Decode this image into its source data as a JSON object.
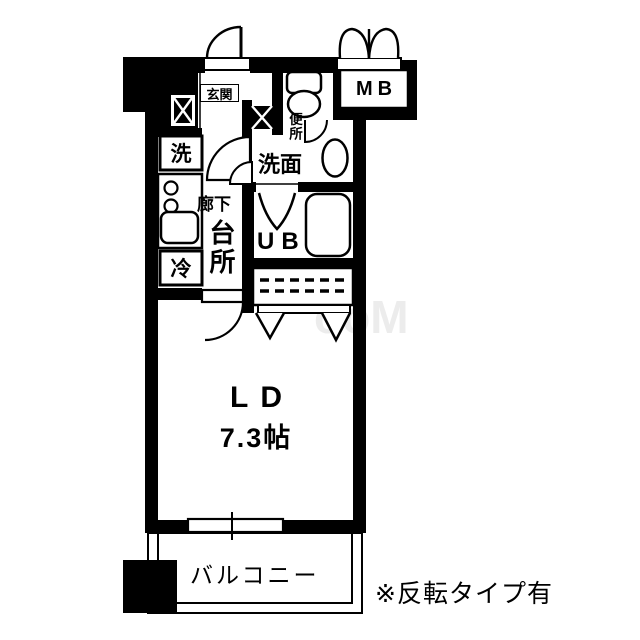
{
  "floor_plan": {
    "labels": {
      "entrance": "玄関",
      "meter_box": "MB",
      "toilet": "便所",
      "washroom": "洗面",
      "washing_machine": "洗",
      "refrigerator": "冷",
      "corridor": "廊下",
      "kitchen": "台所",
      "unit_bath": "UB",
      "living_dining": "LD",
      "living_dining_size": "7.3帖",
      "balcony": "バルコニー"
    },
    "note": "※反転タイプ有",
    "watermark": "ooM",
    "colors": {
      "wall": "#000000",
      "background": "#ffffff",
      "line": "#000000",
      "watermark": "#ececec"
    },
    "icons": [
      "toilet-icon",
      "washbasin-icon",
      "bathtub-icon",
      "stove-burner-icon",
      "kitchen-sink-icon",
      "door-swing-icon",
      "double-door-swing-icon",
      "folding-door-icon",
      "closet-shelf-icon",
      "pipe-space-icon",
      "window-icon"
    ]
  }
}
